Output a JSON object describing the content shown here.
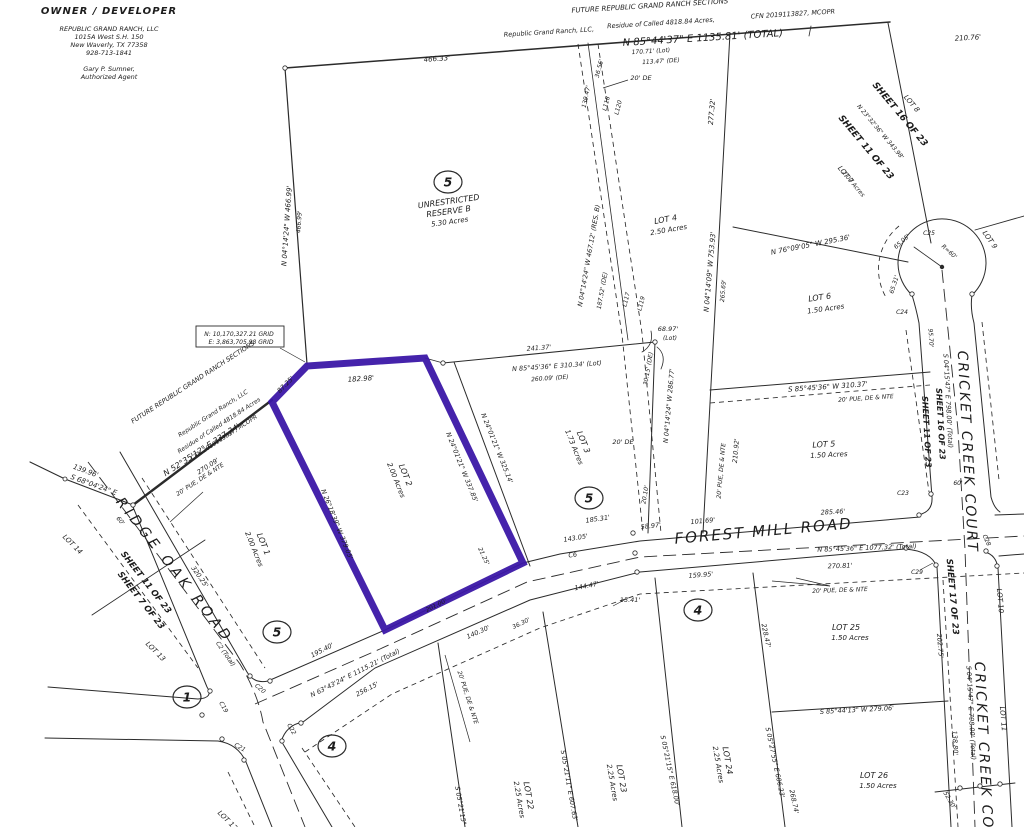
{
  "title": "Plat map - Republic Grand Ranch, Lot 2 highlighted",
  "colors": {
    "paper": "#ffffff",
    "ink": "#262626",
    "highlight": "#3B17A6"
  },
  "owner": {
    "heading": "OWNER / DEVELOPER",
    "lines": [
      "REPUBLIC GRAND RANCH, LLC",
      "1015A West S.H. 150",
      "New Waverly, TX 77358",
      "928-713-1841"
    ],
    "agent": [
      "Gary P. Sumner,",
      "Authorized Agent"
    ]
  },
  "highlighted_lot": {
    "name": "LOT 2",
    "area": "2.00 Acres",
    "boundaries": [
      "87.25'",
      "182.98'",
      "N 24°01'21\" W 337.85'",
      "21.25'",
      "201.00'",
      "N 26°18'39\" W 379.05'"
    ]
  },
  "grid_box": {
    "north": "N: 10,170,327.21 GRID",
    "east": "E: 3,863,705.98 GRID"
  },
  "circled": [
    {
      "n": "5",
      "x": 448,
      "y": 182
    },
    {
      "n": "5",
      "x": 589,
      "y": 498
    },
    {
      "n": "5",
      "x": 277,
      "y": 632
    },
    {
      "n": "1",
      "x": 187,
      "y": 697
    },
    {
      "n": "4",
      "x": 698,
      "y": 610
    },
    {
      "n": "4",
      "x": 332,
      "y": 746
    }
  ],
  "labels": [
    {
      "t": "FUTURE REPUBLIC GRAND RANCH SECTIONS",
      "x": 650,
      "y": 8,
      "r": -3.5,
      "s": 7
    },
    {
      "t": "Republic Grand Ranch, LLC,",
      "x": 549,
      "y": 34,
      "r": -3.5,
      "s": 6.5
    },
    {
      "t": "Residue of Called 4818.84 Acres,",
      "x": 661,
      "y": 25,
      "r": -3.5,
      "s": 6.5
    },
    {
      "t": "CFN 2019113827, MCOPR",
      "x": 793,
      "y": 16,
      "r": -3.5,
      "s": 6.5
    },
    {
      "t": "N 85°44'37\" E  1135.81' (TOTAL)",
      "x": 703,
      "y": 41,
      "r": -3.5,
      "s": 10
    },
    {
      "t": "210.76'",
      "x": 968,
      "y": 40,
      "r": -3.5,
      "s": 7
    },
    {
      "t": "170.71' (Lot)",
      "x": 651,
      "y": 53,
      "r": -3.5,
      "s": 6
    },
    {
      "t": "113.47' (DE)",
      "x": 661,
      "y": 63,
      "r": -3.5,
      "s": 6
    },
    {
      "t": "466.33'",
      "x": 437,
      "y": 61,
      "r": -4,
      "s": 7
    },
    {
      "t": "N 04°14'24\" W  466.99'",
      "x": 289,
      "y": 226,
      "r": -86,
      "s": 7
    },
    {
      "t": "466.99'",
      "x": 301,
      "y": 222,
      "r": -86,
      "s": 6
    },
    {
      "t": "UNRESTRICTED",
      "x": 449,
      "y": 204,
      "r": -8,
      "s": 8
    },
    {
      "t": "RESERVE B",
      "x": 449,
      "y": 214,
      "r": -8,
      "s": 8
    },
    {
      "t": "5.30 Acres",
      "x": 450,
      "y": 224,
      "r": -8,
      "s": 7
    },
    {
      "t": "36.56'",
      "x": 601,
      "y": 69,
      "r": -75,
      "s": 6
    },
    {
      "t": "139.47'",
      "x": 588,
      "y": 97,
      "r": -78,
      "s": 6
    },
    {
      "t": "L118",
      "x": 608,
      "y": 104,
      "r": -75,
      "s": 6
    },
    {
      "t": "L120",
      "x": 620,
      "y": 108,
      "r": -75,
      "s": 6
    },
    {
      "t": "20' DE",
      "x": 641,
      "y": 80,
      "r": 0,
      "s": 6.5
    },
    {
      "t": "N 04°14'24\" W  467.12' (RES. B)",
      "x": 591,
      "y": 256,
      "r": -80,
      "s": 6.5
    },
    {
      "t": "187.52' (DE)",
      "x": 604,
      "y": 291,
      "r": -80,
      "s": 6
    },
    {
      "t": "L117",
      "x": 628,
      "y": 300,
      "r": -75,
      "s": 6
    },
    {
      "t": "L119",
      "x": 643,
      "y": 304,
      "r": -75,
      "s": 6
    },
    {
      "t": "20' DE",
      "x": 623,
      "y": 444,
      "r": 0,
      "s": 6.5
    },
    {
      "t": "N 04°14'24\" W  286.77'",
      "x": 671,
      "y": 406,
      "r": -85,
      "s": 6.5
    },
    {
      "t": "30.15' (DE)",
      "x": 650,
      "y": 369,
      "r": -80,
      "s": 6
    },
    {
      "t": "20.10'",
      "x": 647,
      "y": 495,
      "r": -80,
      "s": 6
    },
    {
      "t": "68.97'",
      "x": 668,
      "y": 331,
      "r": 0,
      "s": 6.5
    },
    {
      "t": "(Lot)",
      "x": 670,
      "y": 340,
      "r": 0,
      "s": 6
    },
    {
      "t": "LOT 4",
      "x": 666,
      "y": 222,
      "r": -10,
      "s": 8
    },
    {
      "t": "2.50 Acres",
      "x": 669,
      "y": 232,
      "r": -10,
      "s": 7
    },
    {
      "t": "277.32'",
      "x": 714,
      "y": 112,
      "r": -85,
      "s": 7
    },
    {
      "t": "N 04°14'09\" W  753.93'",
      "x": 712,
      "y": 272,
      "r": -85,
      "s": 7
    },
    {
      "t": "265.69'",
      "x": 725,
      "y": 291,
      "r": -85,
      "s": 6
    },
    {
      "t": "SHEET 16 OF 23",
      "x": 898,
      "y": 116,
      "r": 50,
      "s": 9,
      "w": "bold"
    },
    {
      "t": "N 23°32'36\" W  343.98'",
      "x": 879,
      "y": 133,
      "r": 50,
      "s": 6
    },
    {
      "t": "SHEET 11 OF 23",
      "x": 864,
      "y": 149,
      "r": 50,
      "s": 9,
      "w": "bold"
    },
    {
      "t": "LOT 8",
      "x": 910,
      "y": 105,
      "r": 50,
      "s": 7
    },
    {
      "t": "LOT 7",
      "x": 844,
      "y": 176,
      "r": 50,
      "s": 7
    },
    {
      "t": "2.00 Acres",
      "x": 852,
      "y": 185,
      "r": 50,
      "s": 6
    },
    {
      "t": "N 76°09'05\" W  295.36'",
      "x": 811,
      "y": 247,
      "r": -11,
      "s": 7
    },
    {
      "t": "C25",
      "x": 929,
      "y": 235,
      "r": 0,
      "s": 6
    },
    {
      "t": "R=60'",
      "x": 948,
      "y": 253,
      "r": 42,
      "s": 6
    },
    {
      "t": "65.05'",
      "x": 903,
      "y": 243,
      "r": -42,
      "s": 6
    },
    {
      "t": "65.31'",
      "x": 896,
      "y": 285,
      "r": -72,
      "s": 6
    },
    {
      "t": "C24",
      "x": 902,
      "y": 314,
      "r": 0,
      "s": 6
    },
    {
      "t": "LOT 9",
      "x": 988,
      "y": 241,
      "r": 55,
      "s": 7
    },
    {
      "t": "LOT 6",
      "x": 820,
      "y": 300,
      "r": -8,
      "s": 8
    },
    {
      "t": "1.50 Acres",
      "x": 826,
      "y": 311,
      "r": -8,
      "s": 7
    },
    {
      "t": "S 85°45'36\" W  310.37'",
      "x": 828,
      "y": 389,
      "r": -4,
      "s": 7
    },
    {
      "t": "20' PUE, DE & NTE",
      "x": 866,
      "y": 400,
      "r": -4,
      "s": 6
    },
    {
      "t": "LOT 5",
      "x": 824,
      "y": 447,
      "r": -3,
      "s": 8
    },
    {
      "t": "1.50 Acres",
      "x": 829,
      "y": 457,
      "r": -3,
      "s": 7
    },
    {
      "t": "210.92'",
      "x": 738,
      "y": 451,
      "r": -85,
      "s": 6.5
    },
    {
      "t": "20' PUE, DE & NTE",
      "x": 723,
      "y": 471,
      "r": -85,
      "s": 6
    },
    {
      "t": "95.70'",
      "x": 929,
      "y": 338,
      "r": 87,
      "s": 6
    },
    {
      "t": "S 04°15'47\" E  798.00' (Total)",
      "x": 946,
      "y": 401,
      "r": 87,
      "s": 6.5
    },
    {
      "t": "SHEET 16 OF 23",
      "x": 938,
      "y": 424,
      "r": 87,
      "s": 8,
      "w": "bold"
    },
    {
      "t": "SHEET 11 OF 23",
      "x": 924,
      "y": 432,
      "r": 87,
      "s": 8,
      "w": "bold"
    },
    {
      "t": "CRICKET CREEK COURT",
      "x": 963,
      "y": 452,
      "r": 87,
      "s": 14,
      "ls": 2
    },
    {
      "t": "185.31'",
      "x": 598,
      "y": 521,
      "r": -8,
      "s": 6.5
    },
    {
      "t": "58.97'",
      "x": 651,
      "y": 528,
      "r": -6,
      "s": 6.5
    },
    {
      "t": "101.69'",
      "x": 703,
      "y": 523,
      "r": -5,
      "s": 6.5
    },
    {
      "t": "143.05'",
      "x": 576,
      "y": 540,
      "r": -9,
      "s": 6.5
    },
    {
      "t": "FOREST MILL ROAD",
      "x": 764,
      "y": 536,
      "r": -5,
      "s": 15,
      "ls": 2
    },
    {
      "t": "285.46'",
      "x": 833,
      "y": 514,
      "r": -3,
      "s": 6.5
    },
    {
      "t": "N 85°45'36\" E  1077.32' (Total)",
      "x": 867,
      "y": 550,
      "r": -2,
      "s": 6.5
    },
    {
      "t": "270.81'",
      "x": 840,
      "y": 568,
      "r": -2,
      "s": 6.5
    },
    {
      "t": "C6",
      "x": 573,
      "y": 557,
      "r": -9,
      "s": 6.5
    },
    {
      "t": "159.95'",
      "x": 701,
      "y": 577,
      "r": -4,
      "s": 6.5
    },
    {
      "t": "144.47'",
      "x": 587,
      "y": 588,
      "r": -11,
      "s": 6.5
    },
    {
      "t": "15.41'",
      "x": 630,
      "y": 602,
      "r": 0,
      "s": 6.5
    },
    {
      "t": "20' PUE, DE & NTE",
      "x": 840,
      "y": 592,
      "r": -2,
      "s": 6
    },
    {
      "t": "36.30'",
      "x": 522,
      "y": 625,
      "r": -26,
      "s": 6
    },
    {
      "t": "140.30'",
      "x": 479,
      "y": 634,
      "r": -24,
      "s": 6.5
    },
    {
      "t": "195.40'",
      "x": 323,
      "y": 652,
      "r": -27,
      "s": 6.5
    },
    {
      "t": "N 63°43'24\" E  1115.21' (Total)",
      "x": 356,
      "y": 675,
      "r": -27,
      "s": 6.5
    },
    {
      "t": "256.15'",
      "x": 368,
      "y": 691,
      "r": -27,
      "s": 6.5
    },
    {
      "t": "C2 (Total)",
      "x": 224,
      "y": 655,
      "r": 55,
      "s": 6
    },
    {
      "t": "C20",
      "x": 259,
      "y": 690,
      "r": 40,
      "s": 6
    },
    {
      "t": "C19",
      "x": 222,
      "y": 708,
      "r": 60,
      "s": 6
    },
    {
      "t": "C21",
      "x": 239,
      "y": 749,
      "r": 30,
      "s": 6
    },
    {
      "t": "C22",
      "x": 290,
      "y": 730,
      "r": 60,
      "s": 6
    },
    {
      "t": "C23",
      "x": 903,
      "y": 495,
      "r": 0,
      "s": 6
    },
    {
      "t": "C29",
      "x": 917,
      "y": 574,
      "r": 0,
      "s": 6
    },
    {
      "t": "C28",
      "x": 985,
      "y": 541,
      "r": 65,
      "s": 6
    },
    {
      "t": "60'",
      "x": 958,
      "y": 485,
      "r": 0,
      "s": 6
    },
    {
      "t": "60'",
      "x": 119,
      "y": 522,
      "r": 50,
      "s": 6
    },
    {
      "t": "139.96'",
      "x": 85,
      "y": 473,
      "r": 20,
      "s": 7
    },
    {
      "t": "S 68°04'24\" E",
      "x": 93,
      "y": 487,
      "r": 20,
      "s": 7
    },
    {
      "t": "N 52°35'12\" E  337.34'",
      "x": 203,
      "y": 452,
      "r": -33,
      "s": 8
    },
    {
      "t": "270.09'",
      "x": 209,
      "y": 468,
      "r": -33,
      "s": 6.5
    },
    {
      "t": "FUTURE REPUBLIC GRAND RANCH SECTIONS",
      "x": 194,
      "y": 384,
      "r": -33,
      "s": 6.5
    },
    {
      "t": "Republic Grand Ranch, LLC",
      "x": 214,
      "y": 415,
      "r": -33,
      "s": 6
    },
    {
      "t": "Residue of Called 4818.84 Acres",
      "x": 220,
      "y": 427,
      "r": -33,
      "s": 6
    },
    {
      "t": "CFN 2019113827, MCOPR",
      "x": 225,
      "y": 439,
      "r": -33,
      "s": 6
    },
    {
      "t": "20' PUE, DE & NTE",
      "x": 201,
      "y": 481,
      "r": -33,
      "s": 6
    },
    {
      "t": "RIDGE OAK ROAD",
      "x": 171,
      "y": 573,
      "r": 52,
      "s": 14,
      "ls": 4
    },
    {
      "t": "320.25'",
      "x": 198,
      "y": 578,
      "r": 55,
      "s": 6.5
    },
    {
      "t": "SHEET 11 OF 23",
      "x": 144,
      "y": 584,
      "r": 52,
      "s": 8.5,
      "w": "bold"
    },
    {
      "t": "SHEET 7 OF 23",
      "x": 139,
      "y": 602,
      "r": 52,
      "s": 8.5,
      "w": "bold"
    },
    {
      "t": "LOT 14",
      "x": 71,
      "y": 546,
      "r": 45,
      "s": 7
    },
    {
      "t": "LOT 13",
      "x": 154,
      "y": 653,
      "r": 45,
      "s": 7
    },
    {
      "t": "LOT 12",
      "x": 226,
      "y": 822,
      "r": 45,
      "s": 7
    },
    {
      "t": "LOT 1",
      "x": 261,
      "y": 545,
      "r": 68,
      "s": 8
    },
    {
      "t": "2.00 Acres",
      "x": 252,
      "y": 550,
      "r": 68,
      "s": 7
    },
    {
      "t": "LOT 2",
      "x": 403,
      "y": 476,
      "r": 68,
      "s": 8
    },
    {
      "t": "2.00 Acres",
      "x": 394,
      "y": 481,
      "r": 68,
      "s": 7
    },
    {
      "t": "LOT 3",
      "x": 581,
      "y": 443,
      "r": 68,
      "s": 8
    },
    {
      "t": "1.73 Acres",
      "x": 572,
      "y": 448,
      "r": 68,
      "s": 7
    },
    {
      "t": "182.98'",
      "x": 361,
      "y": 381,
      "r": -4,
      "s": 7
    },
    {
      "t": "87.25'",
      "x": 287,
      "y": 386,
      "r": -45,
      "s": 6.5
    },
    {
      "t": "N 24°01'21\" W  337.85'",
      "x": 460,
      "y": 468,
      "r": 68,
      "s": 6.5
    },
    {
      "t": "N 24°01'21\" W  325.14'",
      "x": 495,
      "y": 449,
      "r": 68,
      "s": 6.5
    },
    {
      "t": "241.37'",
      "x": 539,
      "y": 350,
      "r": -4,
      "s": 6.5
    },
    {
      "t": "N 85°45'36\" E  310.34' (Lot)",
      "x": 557,
      "y": 368,
      "r": -4,
      "s": 6.5
    },
    {
      "t": "260.09' (DE)",
      "x": 550,
      "y": 380,
      "r": -4,
      "s": 6
    },
    {
      "t": "N 26°18'39\" W  379.05'",
      "x": 335,
      "y": 525,
      "r": 68,
      "s": 6.5
    },
    {
      "t": "21.25'",
      "x": 482,
      "y": 557,
      "r": 65,
      "s": 6
    },
    {
      "t": "201.00'",
      "x": 437,
      "y": 607,
      "r": -26,
      "s": 6
    },
    {
      "t": "20' PUE, DE & NTE",
      "x": 466,
      "y": 698,
      "r": 72,
      "s": 6
    },
    {
      "t": "LOT 22",
      "x": 526,
      "y": 796,
      "r": 80,
      "s": 8
    },
    {
      "t": "2.25 Acres",
      "x": 517,
      "y": 800,
      "r": 80,
      "s": 7
    },
    {
      "t": "LOT 23",
      "x": 619,
      "y": 779,
      "r": 80,
      "s": 8
    },
    {
      "t": "2.25 Acres",
      "x": 610,
      "y": 783,
      "r": 80,
      "s": 7
    },
    {
      "t": "LOT 24",
      "x": 725,
      "y": 761,
      "r": 80,
      "s": 8
    },
    {
      "t": "2.25 Acres",
      "x": 716,
      "y": 765,
      "r": 80,
      "s": 7
    },
    {
      "t": "S 05°21'15\" E",
      "x": 459,
      "y": 809,
      "r": 80,
      "s": 6.5
    },
    {
      "t": "S 05°21'11\" E  607.63'",
      "x": 567,
      "y": 786,
      "r": 80,
      "s": 6.5
    },
    {
      "t": "S 05°21'15\" E  618.00'",
      "x": 668,
      "y": 771,
      "r": 78,
      "s": 6.5
    },
    {
      "t": "S 05°27'55\" E  606.23'",
      "x": 773,
      "y": 763,
      "r": 78,
      "s": 6.5
    },
    {
      "t": "228.47'",
      "x": 764,
      "y": 636,
      "r": 78,
      "s": 6.5
    },
    {
      "t": "268.74'",
      "x": 792,
      "y": 802,
      "r": 78,
      "s": 6.5
    },
    {
      "t": "LOT 25",
      "x": 846,
      "y": 630,
      "r": 0,
      "s": 8
    },
    {
      "t": "1.50 Acres",
      "x": 850,
      "y": 640,
      "r": 0,
      "s": 7
    },
    {
      "t": "S 85°44'13\" W  279.06'",
      "x": 857,
      "y": 712,
      "r": -3,
      "s": 6.5
    },
    {
      "t": "LOT 26",
      "x": 874,
      "y": 778,
      "r": 0,
      "s": 8
    },
    {
      "t": "1.50 Acres",
      "x": 878,
      "y": 788,
      "r": 0,
      "s": 7
    },
    {
      "t": "SHEET 17 OF 23",
      "x": 950,
      "y": 597,
      "r": 85,
      "s": 8.5,
      "w": "bold"
    },
    {
      "t": "202.75'",
      "x": 938,
      "y": 646,
      "r": 85,
      "s": 6.5
    },
    {
      "t": "S 04°15'47\" E  798.00' (Total)",
      "x": 969,
      "y": 713,
      "r": 87,
      "s": 6.5
    },
    {
      "t": "138.80'",
      "x": 953,
      "y": 743,
      "r": 87,
      "s": 6.5
    },
    {
      "t": "LOT 10",
      "x": 998,
      "y": 601,
      "r": 85,
      "s": 7
    },
    {
      "t": "LOT 11",
      "x": 1001,
      "y": 719,
      "r": 85,
      "s": 7
    },
    {
      "t": "52.30'",
      "x": 948,
      "y": 801,
      "r": 60,
      "s": 6
    },
    {
      "t": "CRICKET CREEK COURT",
      "x": 980,
      "y": 763,
      "r": 87,
      "s": 14,
      "ls": 2
    },
    {
      "t": "N: 10,170,327.21 GRID",
      "x": 239,
      "y": 336,
      "r": 0,
      "s": 6
    },
    {
      "t": "E: 3,863,705.98 GRID",
      "x": 241,
      "y": 344,
      "r": 0,
      "s": 6
    }
  ]
}
